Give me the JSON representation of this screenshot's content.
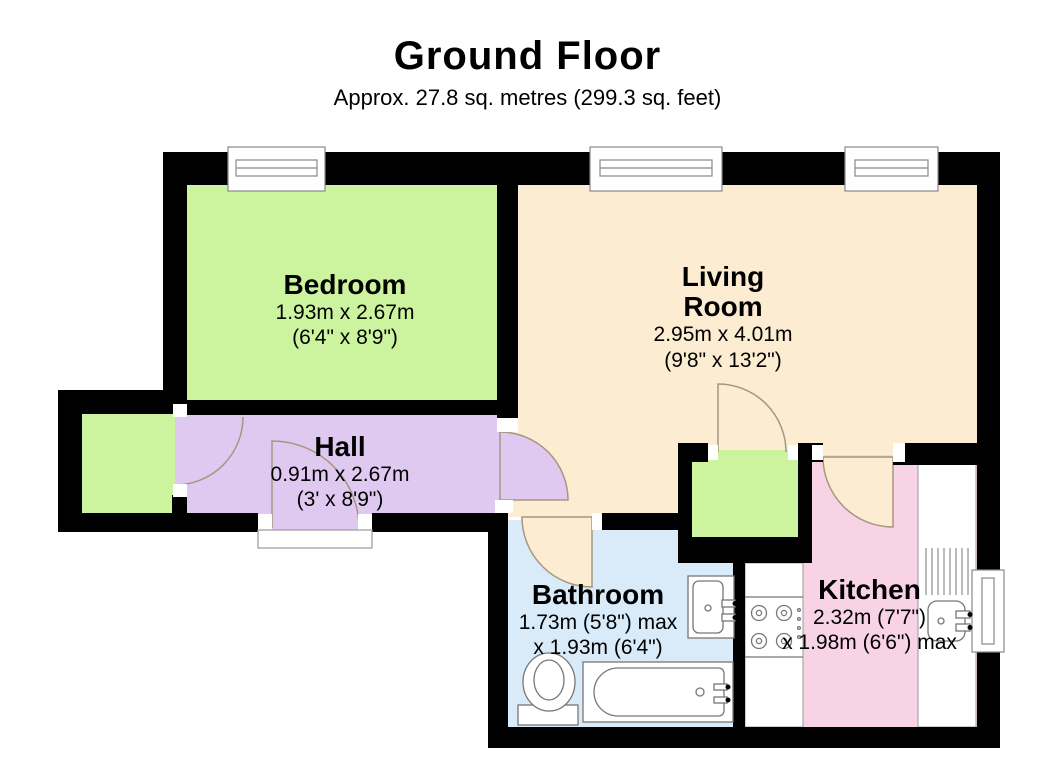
{
  "title": "Ground Floor",
  "subtitle": "Approx. 27.8 sq. metres (299.3 sq. feet)",
  "rooms": {
    "bedroom": {
      "name": "Bedroom",
      "dim_metric": "1.93m x 2.67m",
      "dim_imperial": "(6'4\" x 8'9\")",
      "color": "#ccf49e"
    },
    "living_room": {
      "name": "Living Room",
      "dim_metric": "2.95m x 4.01m",
      "dim_imperial": "(9'8\" x 13'2\")",
      "color": "#fcecd1"
    },
    "hall": {
      "name": "Hall",
      "dim_metric": "0.91m x 2.67m",
      "dim_imperial": "(3' x 8'9\")",
      "color": "#e0c9f1"
    },
    "bathroom": {
      "name": "Bathroom",
      "dim_metric": "1.73m (5'8\") max",
      "dim_imperial": "x 1.93m (6'4\")",
      "color": "#d9eaf9"
    },
    "kitchen": {
      "name": "Kitchen",
      "dim_metric": "2.32m (7'7\")",
      "dim_imperial": "x 1.98m (6'6\") max",
      "color": "#f8d3e6"
    },
    "porch": {
      "color": "#ccf49e"
    },
    "closet": {
      "color": "#ccf49e"
    }
  },
  "colors": {
    "wall": "#000000",
    "door_arc": "#a5977f",
    "fixture_outline": "#777777",
    "window_outline": "#888888",
    "counter": "#ffffff"
  }
}
